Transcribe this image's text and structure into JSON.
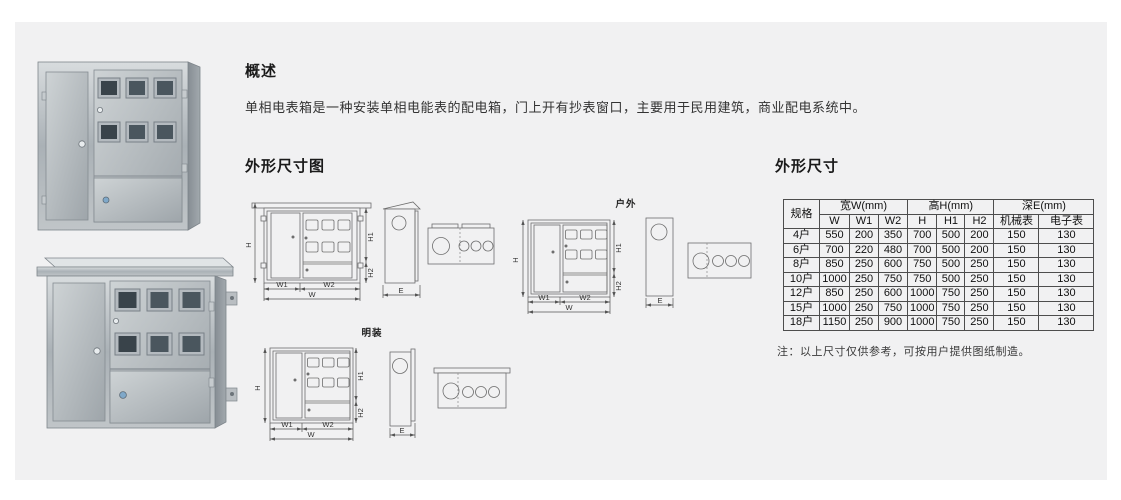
{
  "colors": {
    "panel_bg": "#f1f1f2",
    "diagram_line": "#6e6e6e",
    "text": "#1a1a1a"
  },
  "overview": {
    "title": "概述",
    "body": "单相电表箱是一种安装单相电能表的配电箱，门上开有抄表窗口，主要用于民用建筑，商业配电系统中。"
  },
  "drawings": {
    "title": "外形尺寸图",
    "outdoor_label": "户外",
    "surface_label": "明装",
    "dim_labels": {
      "H": "H",
      "H1": "H1",
      "H2": "H2",
      "W": "W",
      "W1": "W1",
      "W2": "W2",
      "E": "E"
    }
  },
  "dimensions": {
    "title": "外形尺寸",
    "table": {
      "spec_header": "规格",
      "width_group": "宽W(mm)",
      "height_group": "高H(mm)",
      "depth_group": "深E(mm)",
      "sub_headers": [
        "W",
        "W1",
        "W2",
        "H",
        "H1",
        "H2",
        "机械表",
        "电子表"
      ],
      "rows": [
        [
          "4户",
          "550",
          "200",
          "350",
          "700",
          "500",
          "200",
          "150",
          "130"
        ],
        [
          "6户",
          "700",
          "220",
          "480",
          "700",
          "500",
          "200",
          "150",
          "130"
        ],
        [
          "8户",
          "850",
          "250",
          "600",
          "750",
          "500",
          "250",
          "150",
          "130"
        ],
        [
          "10户",
          "1000",
          "250",
          "750",
          "750",
          "500",
          "250",
          "150",
          "130"
        ],
        [
          "12户",
          "850",
          "250",
          "600",
          "1000",
          "750",
          "250",
          "150",
          "130"
        ],
        [
          "15户",
          "1000",
          "250",
          "750",
          "1000",
          "750",
          "250",
          "150",
          "130"
        ],
        [
          "18户",
          "1150",
          "250",
          "900",
          "1000",
          "750",
          "250",
          "150",
          "130"
        ]
      ]
    },
    "note": "注：以上尺寸仅供参考，可按用户提供图纸制造。"
  }
}
